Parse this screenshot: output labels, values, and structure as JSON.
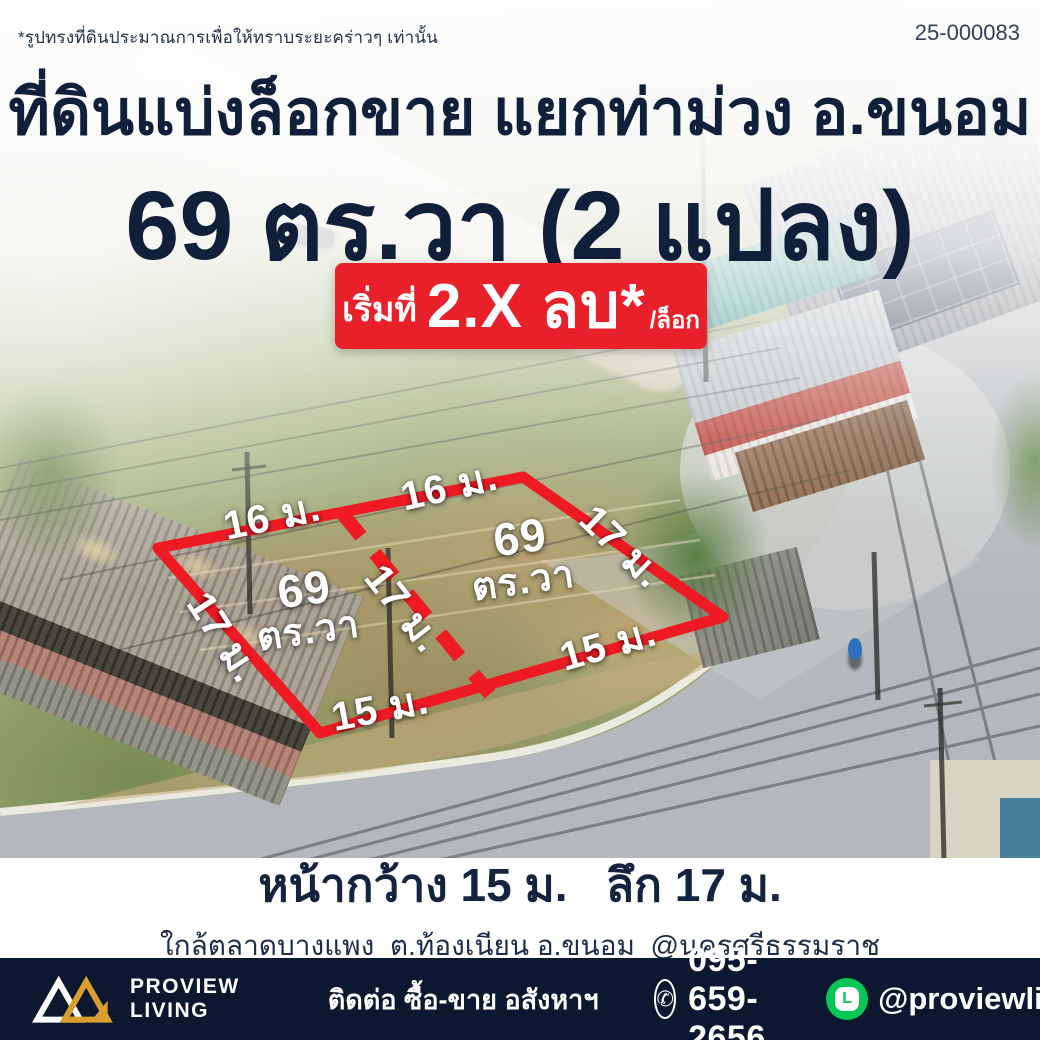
{
  "meta": {
    "disclaimer": "*รูปทรงที่ดินประมาณการเพื่อให้ทราบระยะคร่าวๆ เท่านั้น",
    "ref_no": "25-000083"
  },
  "headline": {
    "line1": "ที่ดินแบ่งล็อกขาย แยกท่าม่วง อ.ขนอม",
    "line2": "69 ตร.วา (2 แปลง)"
  },
  "price_badge": {
    "prefix": "เริ่มที่",
    "price": "2.X ลบ*",
    "unit": "/ล็อก",
    "bg_color": "#e8202a"
  },
  "plot": {
    "outline_color": "#ee1b24",
    "labels": [
      {
        "text": "16 ม.",
        "x": 272,
        "y": 516,
        "rot": -12,
        "size": 40
      },
      {
        "text": "16 ม.",
        "x": 449,
        "y": 486,
        "rot": -13,
        "size": 40
      },
      {
        "text": "17 ม.",
        "x": 622,
        "y": 546,
        "rot": 44,
        "size": 40
      },
      {
        "text": "17 ม.",
        "x": 224,
        "y": 637,
        "rot": 57,
        "size": 40
      },
      {
        "text": "17 ม.",
        "x": 404,
        "y": 608,
        "rot": 52,
        "size": 40
      },
      {
        "text": "15 ม.",
        "x": 608,
        "y": 644,
        "rot": -16,
        "size": 40
      },
      {
        "text": "15 ม.",
        "x": 380,
        "y": 708,
        "rot": -11,
        "size": 40
      },
      {
        "text": "69",
        "x": 304,
        "y": 589,
        "rot": -8,
        "size": 46
      },
      {
        "text": "ตร.วา",
        "x": 308,
        "y": 630,
        "rot": -8,
        "size": 38
      },
      {
        "text": "69",
        "x": 520,
        "y": 537,
        "rot": -8,
        "size": 46
      },
      {
        "text": "ตร.วา",
        "x": 523,
        "y": 580,
        "rot": -8,
        "size": 38
      }
    ]
  },
  "info_band": {
    "line1": "หน้ากว้าง 15 ม.   ลึก 17 ม.",
    "line2": "ใกล้ตลาดบางแพง  ต.ท้องเนียน อ.ขนอม  @นครศรีธรรมราช"
  },
  "footer": {
    "bg_color": "#0c1830",
    "brand_line1": "PROVIEW",
    "brand_line2": "LIVING",
    "brand_gold": "#d99e2e",
    "contact_label": "ติดต่อ ซื้อ-ขาย อสังหาฯ",
    "phone": "095-659-2656",
    "line_id": "@proviewliving",
    "line_green": "#06c755",
    "line_icon_letter": "L"
  }
}
